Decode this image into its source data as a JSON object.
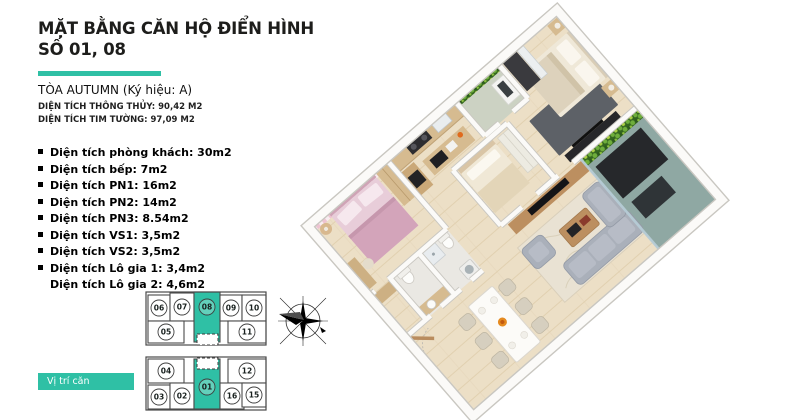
{
  "colors": {
    "accent": "#2fc0a5",
    "wood_floor": "#ecdfc6",
    "wall_edge": "#c9c7c1",
    "wall_face": "#fbfaf8",
    "pink_wall": "#eec3d2",
    "pink_bed": "#d3a4ba",
    "cabinet_wood": "#d6bb90",
    "sofa": "#aab0ba",
    "plant_dark": "#33651f",
    "plant_mid": "#6fae3c",
    "plant_light": "#abd044",
    "balcony_floor": "#8fa8a3",
    "rug_master": "#5d6167",
    "tile": "#eae8e3",
    "dark_furniture": "#26282b"
  },
  "header": {
    "title_line1": "MẶT BẰNG CĂN HỘ ĐIỂN HÌNH",
    "title_line2": "SỐ 01, 08",
    "tower": "TÒA AUTUMN (Ký hiệu: A)",
    "area_net": "DIỆN TÍCH THÔNG THỦY: 90,42  M2",
    "area_gross": "DIỆN TÍCH TIM TƯỜNG:  97,09 M2"
  },
  "room_areas": {
    "items": [
      {
        "bullet": true,
        "text": "Diện tích phòng khách: 30m2"
      },
      {
        "bullet": true,
        "text": "Diện tích bếp:  7m2"
      },
      {
        "bullet": true,
        "text": "Diện tích PN1: 16m2"
      },
      {
        "bullet": true,
        "text": "Diện tích PN2: 14m2"
      },
      {
        "bullet": true,
        "text": "Diện tích PN3: 8.54m2"
      },
      {
        "bullet": true,
        "text": "Diện tích VS1:  3,5m2"
      },
      {
        "bullet": true,
        "text": "Diện tích VS2:  3,5m2"
      },
      {
        "bullet": true,
        "text": "Diện tích Lô gia 1:  3,4m2"
      },
      {
        "bullet": false,
        "text": "Diện tích Lô gia 2:  4,6m2"
      }
    ]
  },
  "unit_map": {
    "legend_label": "Vị trí căn",
    "highlighted_units": [
      "08",
      "01"
    ],
    "units": [
      {
        "no": "06",
        "x": 4,
        "y": 6,
        "w": 22,
        "h": 26,
        "hl": false
      },
      {
        "no": "07",
        "x": 26,
        "y": 4,
        "w": 24,
        "h": 28,
        "hl": false
      },
      {
        "no": "08",
        "x": 50,
        "y": 3,
        "w": 26,
        "h": 50,
        "cy": 18,
        "hl": true
      },
      {
        "no": "09",
        "x": 76,
        "y": 6,
        "w": 22,
        "h": 26,
        "hl": false
      },
      {
        "no": "10",
        "x": 98,
        "y": 6,
        "w": 24,
        "h": 26,
        "hl": false
      },
      {
        "no": "05",
        "x": 4,
        "y": 32,
        "w": 36,
        "h": 22,
        "hl": false
      },
      {
        "no": "11",
        "x": 84,
        "y": 32,
        "w": 38,
        "h": 22,
        "hl": false
      },
      {
        "no": "04",
        "x": 4,
        "y": 70,
        "w": 36,
        "h": 24,
        "hl": false
      },
      {
        "no": "12",
        "x": 84,
        "y": 70,
        "w": 38,
        "h": 24,
        "hl": false
      },
      {
        "no": "03",
        "x": 4,
        "y": 96,
        "w": 22,
        "h": 24,
        "hl": false
      },
      {
        "no": "02",
        "x": 26,
        "y": 94,
        "w": 24,
        "h": 26,
        "hl": false
      },
      {
        "no": "01",
        "x": 50,
        "y": 70,
        "w": 26,
        "h": 50,
        "cy": 98,
        "hl": true
      },
      {
        "no": "16",
        "x": 76,
        "y": 94,
        "w": 24,
        "h": 26,
        "hl": false
      },
      {
        "no": "15",
        "x": 98,
        "y": 94,
        "w": 24,
        "h": 24,
        "hl": false
      }
    ]
  }
}
